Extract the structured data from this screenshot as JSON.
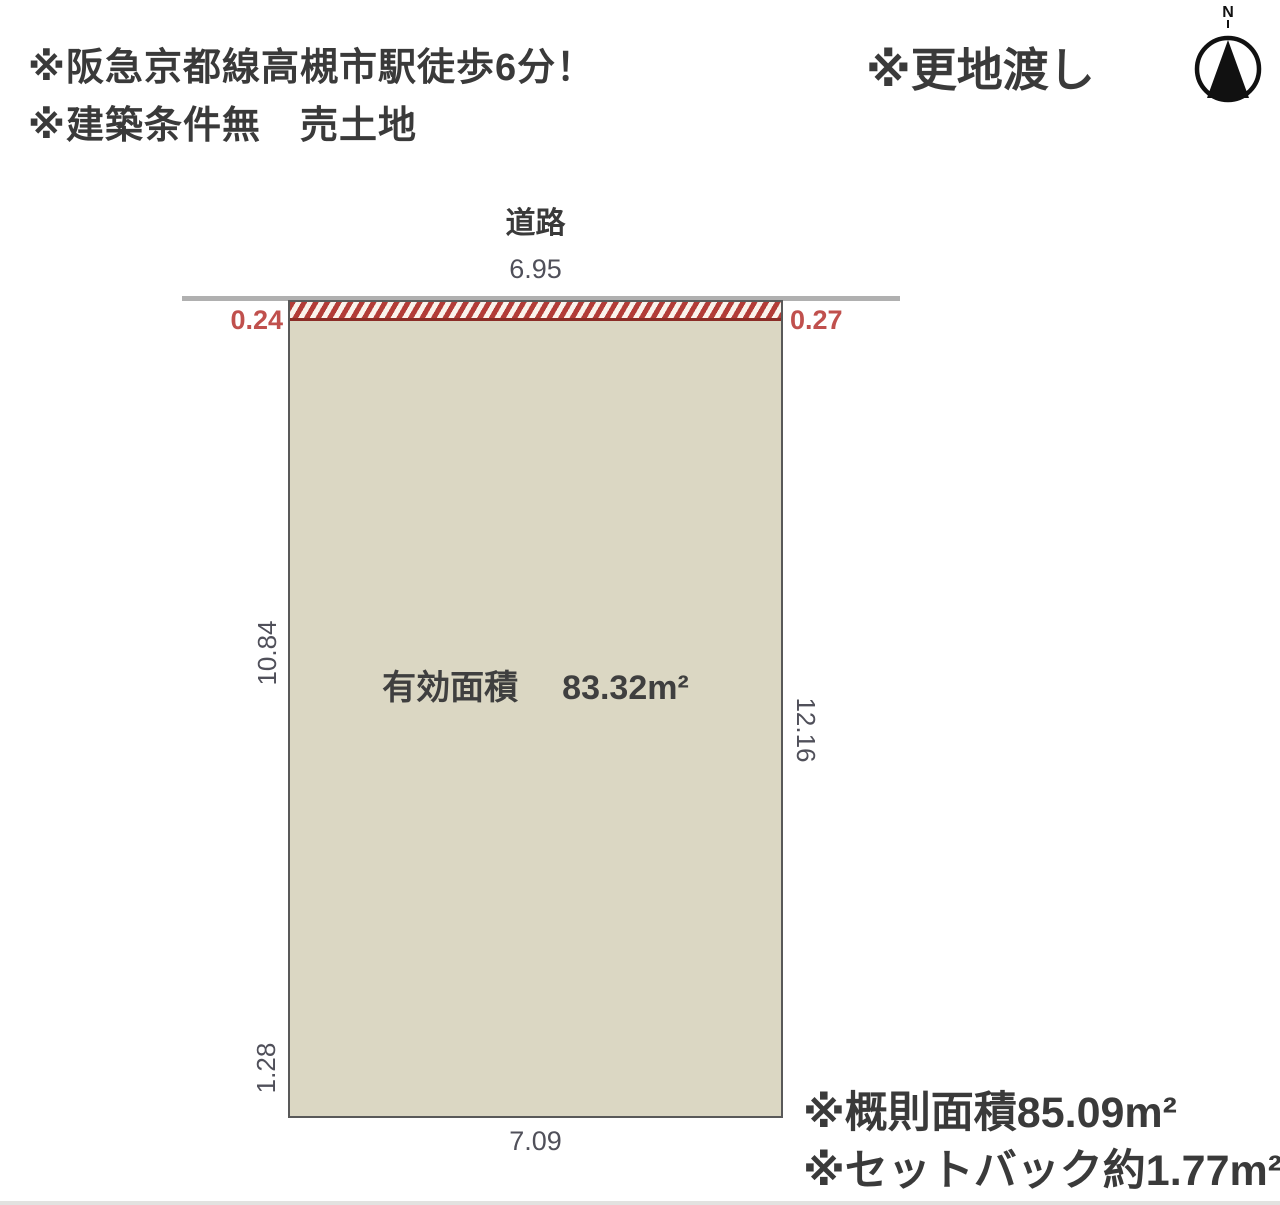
{
  "header": {
    "line1": "※阪急京都線高槻市駅徒歩6分！",
    "line2": "※建築条件無　売土地",
    "vacant_note": "※更地渡し"
  },
  "compass": {
    "label": "N"
  },
  "diagram": {
    "road_label": "道路",
    "road_width_dim": "6.95",
    "setback_left_dim": "0.24",
    "setback_right_dim": "0.27",
    "left_side_dim": "10.84",
    "right_side_dim": "12.16",
    "left_lower_dim": "1.28",
    "bottom_dim": "7.09",
    "area_label": "有効面積",
    "area_value": "83.32m²"
  },
  "footer": {
    "note1": "※概則面積85.09m²",
    "note2": "※セットバック約1.77m²"
  },
  "colors": {
    "plot_fill": "#dbd7c3",
    "plot_border": "#595959",
    "hatch_stripe": "#b23c37",
    "hatch_border": "#8b2d26",
    "dim_red": "#c0504d",
    "dim_gray": "#50505a",
    "road_line": "#b0b0b0",
    "text_dark": "#3a3a3a"
  }
}
